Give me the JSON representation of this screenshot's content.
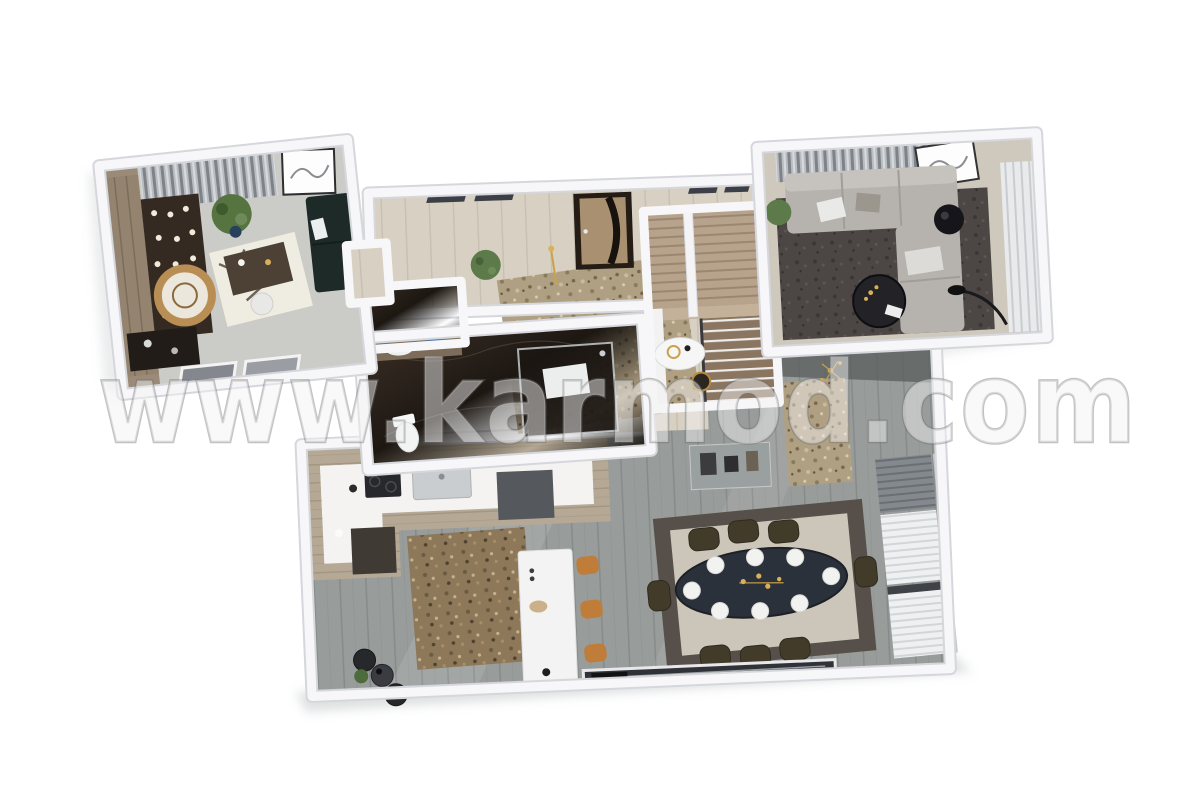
{
  "watermark": {
    "text": "www.karmod.com"
  },
  "scene": {
    "type": "3d-floor-plan-render",
    "rooms": [
      {
        "id": "study-office"
      },
      {
        "id": "entry-hall"
      },
      {
        "id": "bathroom"
      },
      {
        "id": "staircase"
      },
      {
        "id": "lounge"
      },
      {
        "id": "open-living-kitchen-dining"
      }
    ]
  },
  "palette": {
    "bg": "#ffffff",
    "wallTop": "#f7f7f9",
    "wallShade": "#d5d7dc",
    "wallFace": "#c9cbd1",
    "floorGray": "#979b99",
    "floorBeige": "#d7d0c2",
    "officeFloor": "#cbccc8",
    "marbleDark": "#241d17",
    "rugTan": "#b0a083",
    "rugBrown": "#8d785a",
    "rugDark": "#4c4744",
    "rugDining": "#ccc5b9",
    "rugDiningBorder": "#57504a",
    "sofaGray": "#b6b2ad",
    "sofaDark": "#1d2a28",
    "tableDark": "#2b313a",
    "chairOlive": "#433b29",
    "stoolOrange": "#c07d39",
    "counterWood": "#b5a996",
    "counterTop": "#f4f3f1",
    "stairWood": "#b7a28b",
    "doorBrown": "#241c15",
    "doorPanel": "#a89070",
    "plantGreen": "#5d7a4b",
    "gold": "#c9a24a",
    "curtainGray": "#b9bdc1",
    "watermarkInk": "#6e6e6e"
  }
}
